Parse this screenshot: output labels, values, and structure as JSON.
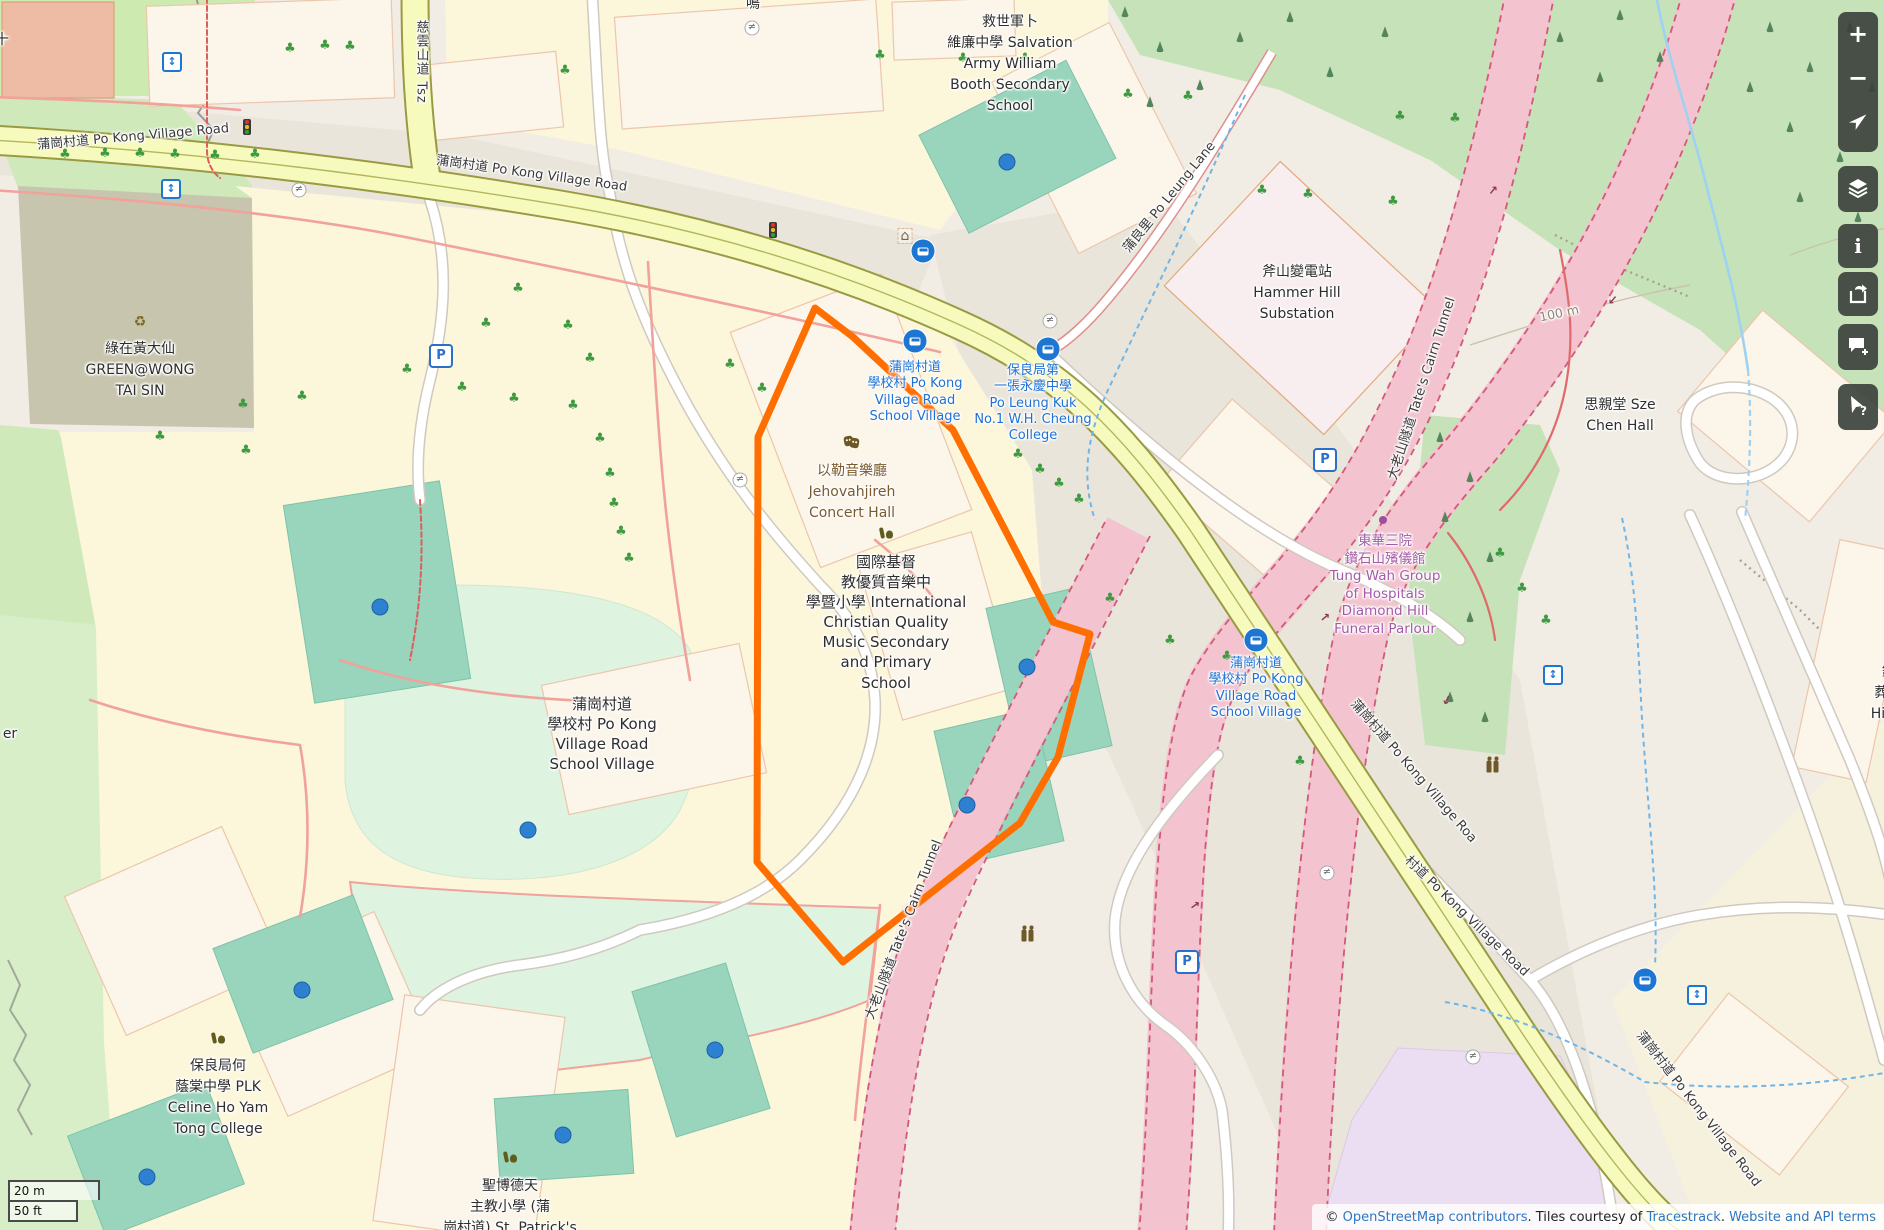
{
  "map": {
    "attribution": {
      "prefix": "© ",
      "osm_link": "OpenStreetMap contributors",
      "middle": ". Tiles courtesy of ",
      "tiles_link": "Tracestrack",
      "separator": ". ",
      "terms_link": "Website and API terms"
    },
    "scalebar": {
      "metric": "20 m",
      "imperial": "50 ft"
    },
    "controls": [
      {
        "name": "zoom-in-button",
        "icon": "plus-icon",
        "glyph": "+"
      },
      {
        "name": "zoom-out-button",
        "icon": "minus-icon",
        "glyph": "−"
      },
      {
        "name": "locate-button",
        "icon": "locate-arrow-icon",
        "glyph": ""
      },
      {
        "name": "layers-button",
        "icon": "layers-icon",
        "glyph": ""
      },
      {
        "name": "map-legend-button",
        "icon": "info-icon",
        "glyph": "i"
      },
      {
        "name": "share-button",
        "icon": "share-icon",
        "glyph": ""
      },
      {
        "name": "add-note-button",
        "icon": "note-bubble-icon",
        "glyph": ""
      },
      {
        "name": "query-features-button",
        "icon": "query-cursor-icon",
        "glyph": "?"
      }
    ],
    "place_labels": [
      {
        "name": "salvation-army-school-label",
        "x": 1010,
        "y": 12,
        "lines": [
          "救世軍卜",
          "維廉中學 Salvation",
          "Army William",
          "Booth Secondary",
          "School"
        ],
        "style": "dark"
      },
      {
        "name": "hammer-hill-substation-label",
        "x": 1297,
        "y": 262,
        "lines": [
          "斧山變電站",
          "Hammer Hill",
          "Substation"
        ],
        "style": "dark"
      },
      {
        "name": "green-wong-tai-sin-label",
        "x": 140,
        "y": 339,
        "lines": [
          "綠在黃大仙",
          "GREEN@WONG",
          "TAI SIN"
        ],
        "style": "dark",
        "icon": "recycle",
        "icon_y": 322
      },
      {
        "name": "po-kong-village-road-school-village-label",
        "x": 602,
        "y": 694,
        "lines": [
          "蒲崗村道",
          "學校村 Po Kong",
          "Village Road",
          "School Village"
        ],
        "style": "dark size15"
      },
      {
        "name": "jehovahjireh-concert-hall-label",
        "x": 852,
        "y": 461,
        "lines": [
          "以勒音樂廳",
          "Jehovahjireh",
          "Concert Hall"
        ],
        "style": "brown",
        "icon": "masks",
        "icon_y": 442
      },
      {
        "name": "international-christian-quality-music-school-label",
        "x": 886,
        "y": 552,
        "lines": [
          "國際基督",
          "教優質音樂中",
          "學暨小學 International",
          "Christian Quality",
          "Music Secondary",
          "and Primary",
          "School"
        ],
        "style": "dark size15",
        "icon": "school",
        "icon_y": 533
      },
      {
        "name": "plk-celine-ho-yam-tong-college-label",
        "x": 218,
        "y": 1056,
        "lines": [
          "保良局何",
          "蔭棠中學 PLK",
          "Celine Ho Yam",
          "Tong College"
        ],
        "style": "dark",
        "icon": "school",
        "icon_y": 1038
      },
      {
        "name": "st-patricks-school-label",
        "x": 510,
        "y": 1176,
        "lines": [
          "聖博德天",
          "主教小學 (蒲",
          "崗村道) St. Patrick's"
        ],
        "style": "dark",
        "icon": "school",
        "icon_y": 1157
      },
      {
        "name": "sze-chen-hall-label",
        "x": 1620,
        "y": 395,
        "lines": [
          "思親堂 Sze",
          "Chen Hall"
        ],
        "style": "dark"
      },
      {
        "name": "funeral-parlour-label",
        "x": 1385,
        "y": 533,
        "lines": [
          "東華三院",
          "鑽石山殯儀館",
          "Tung Wah Group",
          "of Hospitals",
          "Diamond Hill",
          "Funeral Parlour"
        ],
        "style": "purple"
      },
      {
        "name": "diamond-hill-crematorium-partial-label",
        "x": 1896,
        "y": 662,
        "lines": [
          "鑽石",
          "葬場 D",
          "Hill Cre"
        ],
        "style": "dark"
      },
      {
        "name": "partial-label-er",
        "x": 10,
        "y": 724,
        "lines": [
          "er"
        ],
        "style": "dark"
      },
      {
        "name": "partial-label-top-left",
        "x": 2,
        "y": 30,
        "lines": [
          "十"
        ],
        "style": "dark"
      },
      {
        "name": "partial-label-top-street",
        "x": 753,
        "y": -6,
        "lines": [
          "鳴"
        ],
        "style": "dark"
      }
    ],
    "transit_labels": [
      {
        "name": "school-village-bus-stop-label-west",
        "x": 915,
        "y": 360,
        "lines": [
          "蒲崗村道",
          "學校村 Po Kong",
          "Village Road",
          "School Village"
        ]
      },
      {
        "name": "po-leung-kuk-college-bus-stop-label",
        "x": 1033,
        "y": 363,
        "lines": [
          "保良局第",
          "一張永慶中學",
          "Po Leung Kuk",
          "No.1 W.H. Cheung",
          "College"
        ]
      },
      {
        "name": "school-village-bus-stop-label-east",
        "x": 1256,
        "y": 656,
        "lines": [
          "蒲崗村道",
          "學校村 Po Kong",
          "Village Road",
          "School Village"
        ]
      }
    ],
    "road_labels": [
      {
        "name": "po-kong-village-road-label-1",
        "text": "蒲崗村道 Po Kong Village Road",
        "x": 133,
        "y": 135,
        "rot": -5
      },
      {
        "name": "po-kong-village-road-label-2",
        "text": "蒲崗村道 Po Kong Village Road",
        "x": 532,
        "y": 172,
        "rot": 8
      },
      {
        "name": "tsz-wan-shan-road-label",
        "text": "慈雲山道 Tsz",
        "x": 421,
        "y": 62,
        "rot": 0,
        "vertical": true
      },
      {
        "name": "po-leung-lane-label",
        "text": "蒲良里 Po Leung Lane",
        "x": 1168,
        "y": 196,
        "rot": -51
      },
      {
        "name": "po-kong-village-road-label-3",
        "text": "蒲崗村道 Po Kong Village Roa",
        "x": 1415,
        "y": 770,
        "rot": 49
      },
      {
        "name": "po-kong-village-road-label-4",
        "text": "村道 Po Kong Village Road",
        "x": 1468,
        "y": 915,
        "rot": 44,
        "muted": false
      },
      {
        "name": "po-kong-village-road-label-5",
        "text": "蒲崗村道 Po Kong Village Road",
        "x": 1700,
        "y": 1108,
        "rot": 52
      },
      {
        "name": "tates-cairn-tunnel-label-1",
        "text": "大老山隧道 Tate's Cairn Tunnel",
        "x": 1420,
        "y": 388,
        "rot": -72
      },
      {
        "name": "tates-cairn-tunnel-label-2",
        "text": "大老山隧道 Tate's Cairn Tunnel",
        "x": 902,
        "y": 929,
        "rot": -69
      },
      {
        "name": "contour-100m-label",
        "text": "100 m",
        "x": 1559,
        "y": 313,
        "rot": -12,
        "muted": true
      }
    ],
    "icons": [
      {
        "type": "elevator",
        "x": 172,
        "y": 62
      },
      {
        "type": "elevator",
        "x": 171,
        "y": 189
      },
      {
        "type": "elevator",
        "x": 1553,
        "y": 675
      },
      {
        "type": "elevator",
        "x": 1697,
        "y": 995
      },
      {
        "type": "bus",
        "x": 923,
        "y": 251
      },
      {
        "type": "bus",
        "x": 915,
        "y": 341
      },
      {
        "type": "bus",
        "x": 1048,
        "y": 349
      },
      {
        "type": "bus",
        "x": 1256,
        "y": 640
      },
      {
        "type": "bus",
        "x": 1645,
        "y": 980
      },
      {
        "type": "parking",
        "x": 441,
        "y": 356
      },
      {
        "type": "parking",
        "x": 1325,
        "y": 460
      },
      {
        "type": "parking",
        "x": 1187,
        "y": 962
      },
      {
        "type": "traffic-light",
        "x": 247,
        "y": 127
      },
      {
        "type": "traffic-light",
        "x": 773,
        "y": 230
      },
      {
        "type": "shelter",
        "x": 905,
        "y": 236
      },
      {
        "type": "toilets",
        "x": 1495,
        "y": 766
      },
      {
        "type": "toilets",
        "x": 1030,
        "y": 935
      },
      {
        "type": "gate",
        "x": 299,
        "y": 190
      },
      {
        "type": "gate",
        "x": 752,
        "y": 28
      },
      {
        "type": "gate",
        "x": 740,
        "y": 480
      },
      {
        "type": "gate",
        "x": 1050,
        "y": 321
      },
      {
        "type": "gate",
        "x": 1327,
        "y": 873
      },
      {
        "type": "gate",
        "x": 1473,
        "y": 1057
      },
      {
        "type": "oneway-arrow",
        "x": 1493,
        "y": 190,
        "rot": -50
      },
      {
        "type": "oneway-arrow",
        "x": 1613,
        "y": 300,
        "rot": 130
      },
      {
        "type": "oneway-arrow",
        "x": 1325,
        "y": 617,
        "rot": -40
      },
      {
        "type": "oneway-arrow",
        "x": 1195,
        "y": 905,
        "rot": -35
      },
      {
        "type": "oneway-arrow",
        "x": 1447,
        "y": 700,
        "rot": 115
      },
      {
        "type": "purple-dot",
        "x": 1383,
        "y": 520
      }
    ],
    "water_dots": [
      {
        "x": 1007,
        "y": 162
      },
      {
        "x": 380,
        "y": 607
      },
      {
        "x": 528,
        "y": 830
      },
      {
        "x": 1027,
        "y": 667
      },
      {
        "x": 967,
        "y": 805
      },
      {
        "x": 302,
        "y": 990
      },
      {
        "x": 147,
        "y": 1177
      },
      {
        "x": 563,
        "y": 1135
      },
      {
        "x": 715,
        "y": 1050
      }
    ],
    "trees": [
      [
        65,
        156
      ],
      [
        105,
        155
      ],
      [
        140,
        155
      ],
      [
        175,
        156
      ],
      [
        215,
        157
      ],
      [
        255,
        156
      ],
      [
        290,
        50
      ],
      [
        325,
        47
      ],
      [
        350,
        48
      ],
      [
        565,
        72
      ],
      [
        880,
        57
      ],
      [
        963,
        60
      ],
      [
        1025,
        60
      ],
      [
        1128,
        96
      ],
      [
        1188,
        98
      ],
      [
        1400,
        118
      ],
      [
        1262,
        192
      ],
      [
        1308,
        196
      ],
      [
        1393,
        203
      ],
      [
        1455,
        120
      ],
      [
        518,
        290
      ],
      [
        568,
        327
      ],
      [
        590,
        360
      ],
      [
        573,
        407
      ],
      [
        514,
        400
      ],
      [
        486,
        325
      ],
      [
        600,
        440
      ],
      [
        610,
        475
      ],
      [
        614,
        505
      ],
      [
        621,
        533
      ],
      [
        629,
        560
      ],
      [
        302,
        398
      ],
      [
        243,
        406
      ],
      [
        246,
        452
      ],
      [
        160,
        438
      ],
      [
        730,
        366
      ],
      [
        762,
        390
      ],
      [
        407,
        371
      ],
      [
        462,
        389
      ],
      [
        1018,
        456
      ],
      [
        1040,
        471
      ],
      [
        1059,
        485
      ],
      [
        1079,
        501
      ],
      [
        1110,
        600
      ],
      [
        1170,
        642
      ],
      [
        1227,
        658
      ],
      [
        1300,
        763
      ],
      [
        1500,
        555
      ],
      [
        1522,
        590
      ],
      [
        1546,
        622
      ]
    ],
    "conifers": [
      [
        1125,
        15
      ],
      [
        1160,
        50
      ],
      [
        1200,
        88
      ],
      [
        1240,
        40
      ],
      [
        1150,
        105
      ],
      [
        1290,
        20
      ],
      [
        1330,
        75
      ],
      [
        1385,
        35
      ],
      [
        1560,
        40
      ],
      [
        1600,
        80
      ],
      [
        1620,
        18
      ],
      [
        1660,
        60
      ],
      [
        1770,
        30
      ],
      [
        1810,
        70
      ],
      [
        1850,
        30
      ],
      [
        1872,
        90
      ],
      [
        1790,
        130
      ],
      [
        1840,
        160
      ],
      [
        1858,
        220
      ],
      [
        1800,
        200
      ],
      [
        1750,
        90
      ],
      [
        1440,
        440
      ],
      [
        1470,
        480
      ],
      [
        1445,
        520
      ],
      [
        1490,
        560
      ],
      [
        1470,
        620
      ],
      [
        1450,
        700
      ],
      [
        1485,
        720
      ]
    ]
  }
}
